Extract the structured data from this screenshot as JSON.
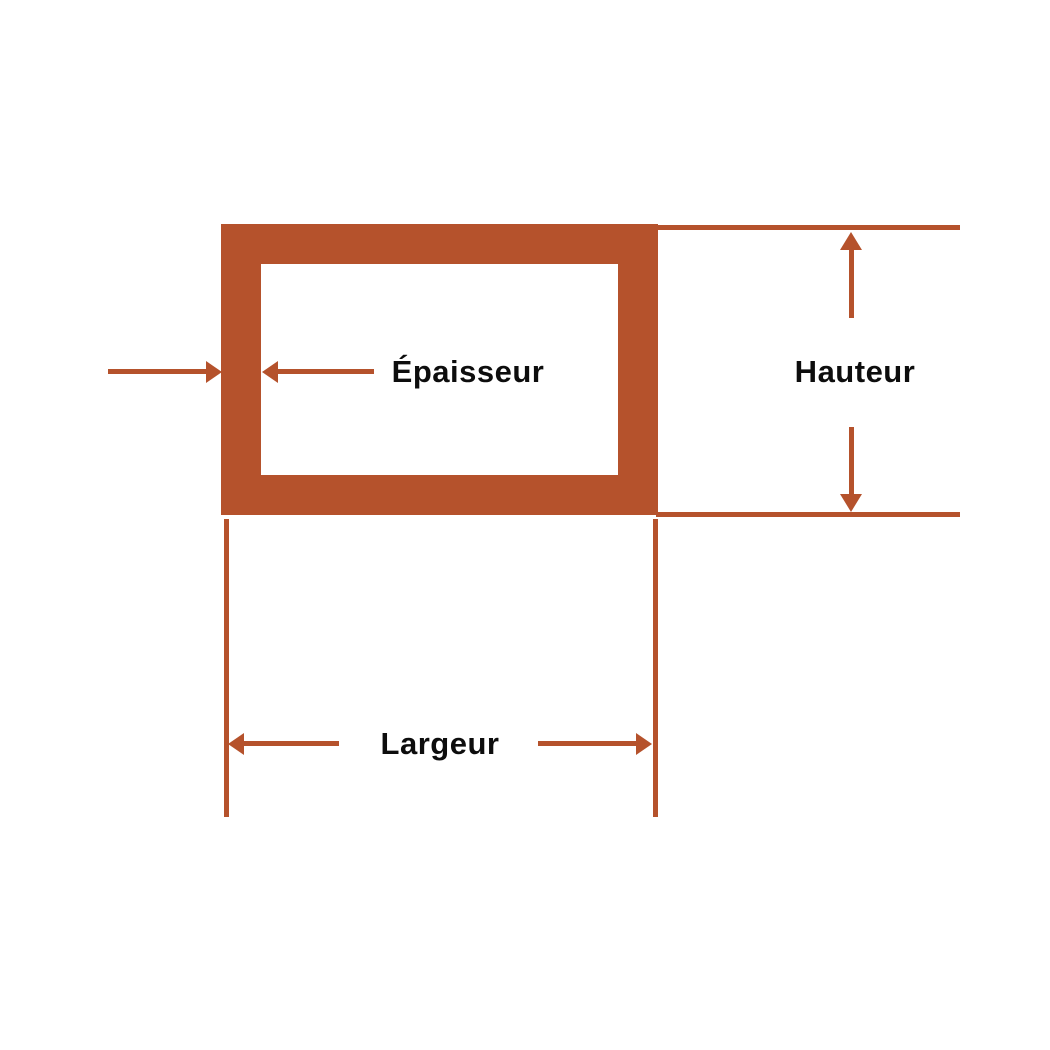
{
  "colors": {
    "accent": "#B5522C",
    "text": "#0D0D0D",
    "background": "#FFFFFF"
  },
  "labels": {
    "thickness": "Épaisseur",
    "height": "Hauteur",
    "width": "Largeur"
  }
}
